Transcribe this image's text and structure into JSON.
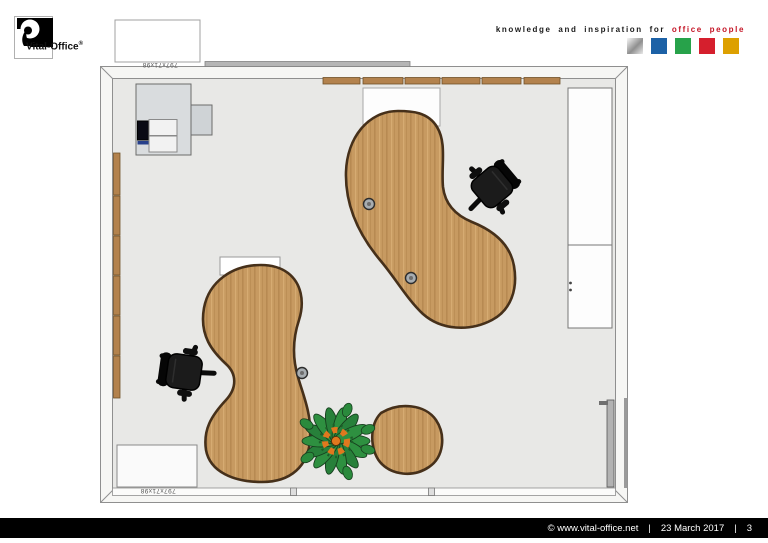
{
  "header": {
    "logo": {
      "brand": "Vital-Office",
      "registered": "®"
    },
    "tagline": {
      "black": "knowledge and inspiration for",
      "red": "office people"
    },
    "palette": {
      "silver": "#c6c6c6",
      "blue": "#1c61a6",
      "green": "#27a24a",
      "red": "#d51f2d",
      "gold": "#dda000"
    }
  },
  "plan": {
    "dim_top": "797x71x98",
    "dim_bottom": "797x71x98",
    "colors": {
      "floor": "#e8e8e6",
      "wall_band": "#f6f6f4",
      "wood": "#c79a61",
      "wood_edge": "#46301a",
      "wall_panel": "#b3824d",
      "chair": "#141414",
      "plant_green": "#2e9040",
      "plant_orange": "#e0781e"
    }
  },
  "footer": {
    "copyright": "©  www.vital-office.net",
    "sep": "|",
    "date": "23 March 2017",
    "page": "3"
  }
}
